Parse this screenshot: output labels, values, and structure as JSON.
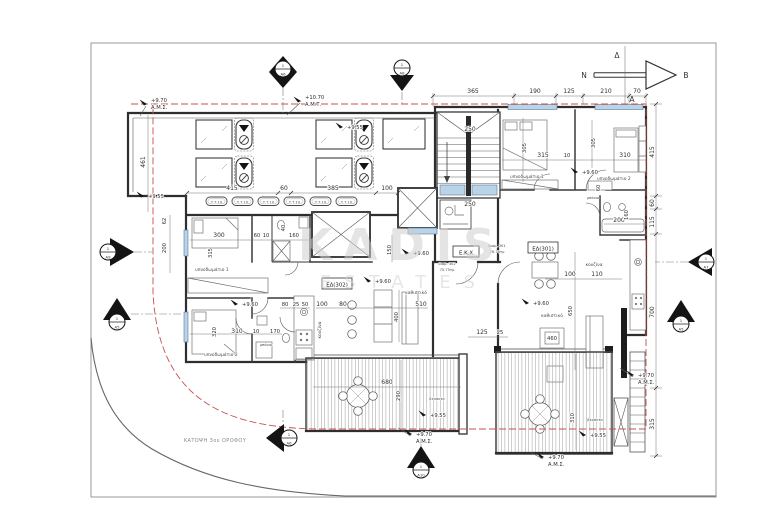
{
  "sheet": {
    "caption": "ΚΑΤΟΨΗ 3ου ΟΡΟΦΟΥ"
  },
  "watermark": {
    "brand": "KADIS",
    "sub": "ESTATES"
  },
  "compass": {
    "north": "Β",
    "south": "Ν",
    "west": "Δ",
    "east": "Α"
  },
  "colors": {
    "boundary_red": "#c4524e",
    "glass_blue": "#b9d3e8",
    "ink": "#2e2e2e"
  },
  "rooms": {
    "bedroom1": "υπνοδωμάτιο 1",
    "bedroom2": "υπνοδωμάτιο 2",
    "kitchen": "κουζίνα",
    "living": "καθιστικό",
    "bath": "μπάνιο",
    "veranda": "βεράντα",
    "common": "Ε.Κ.Χ"
  },
  "apartments": {
    "a302": {
      "code": "ΕΔ(302)",
      "name": "διαμ. 302",
      "area": "75.75τμ"
    },
    "a301": {
      "code": "ΕΔ(301)",
      "name": "διαμ. 301",
      "area": "76.76τμ"
    }
  },
  "roof": {
    "unit_label": "Τ.Τ.10"
  },
  "levels": {
    "v970": "+9.70",
    "v1070": "+10.70",
    "v960": "+9.60",
    "v955": "+9.55",
    "ams": "Α.Μ.Σ.",
    "amt": "Α.Μ.Τ."
  },
  "markers": {
    "num": "1",
    "a5": "Α5",
    "a6": "Α6",
    "a7": "Α7",
    "a8": "Α8",
    "a9": "Α9",
    "a10": "Α10"
  },
  "dims": {
    "top": [
      "365",
      "190",
      "125",
      "210",
      "70"
    ],
    "right": [
      "415",
      "60",
      "115",
      "700",
      "315"
    ],
    "left": [
      "461",
      "62",
      "200"
    ],
    "roof_bottom": [
      "415",
      "60",
      "385",
      "100"
    ],
    "stair": [
      "250",
      "250"
    ],
    "bed1_left": [
      "300",
      "315",
      "60",
      "10",
      "160",
      "40"
    ],
    "bed2_left": [
      "320",
      "310",
      "10",
      "170"
    ],
    "living_left": [
      "80",
      "25",
      "50",
      "100",
      "80",
      "510",
      "400",
      "150"
    ],
    "veranda_left": [
      "680",
      "290"
    ],
    "recess": [
      "125",
      "25"
    ],
    "bed_right": [
      "315",
      "10",
      "310",
      "305",
      "305",
      "60"
    ],
    "bath_right": [
      "200",
      "160"
    ],
    "kitchen_right": [
      "100",
      "110"
    ],
    "living_right": [
      "650",
      "460"
    ],
    "veranda_right": [
      "310"
    ]
  }
}
